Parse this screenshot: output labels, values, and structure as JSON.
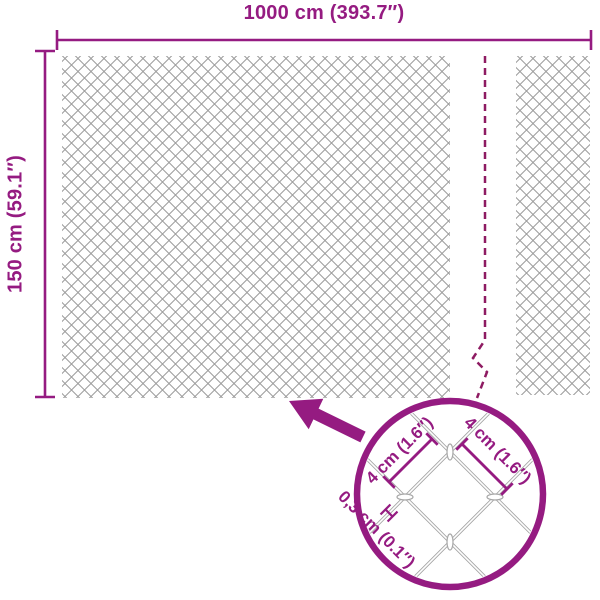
{
  "dimensions": {
    "width_label": "1000 cm (393.7″)",
    "height_label": "150 cm (59.1″)"
  },
  "detail": {
    "mesh_left_label": "4 cm (1.6″)",
    "mesh_right_label": "4 cm (1.6″)",
    "wire_label": "0,3 cm (0.1″)"
  },
  "icons": {
    "arrow": "zoom-pointer-arrow",
    "circle": "magnifier-detail-circle",
    "wire_gauge": "wire-thickness-h-marker"
  },
  "colors": {
    "accent_purple": "#951b81",
    "break_line": "#8e1b62",
    "mesh_gray": "#9c9c9c",
    "detail_mesh_gray": "#a6a6a6"
  }
}
